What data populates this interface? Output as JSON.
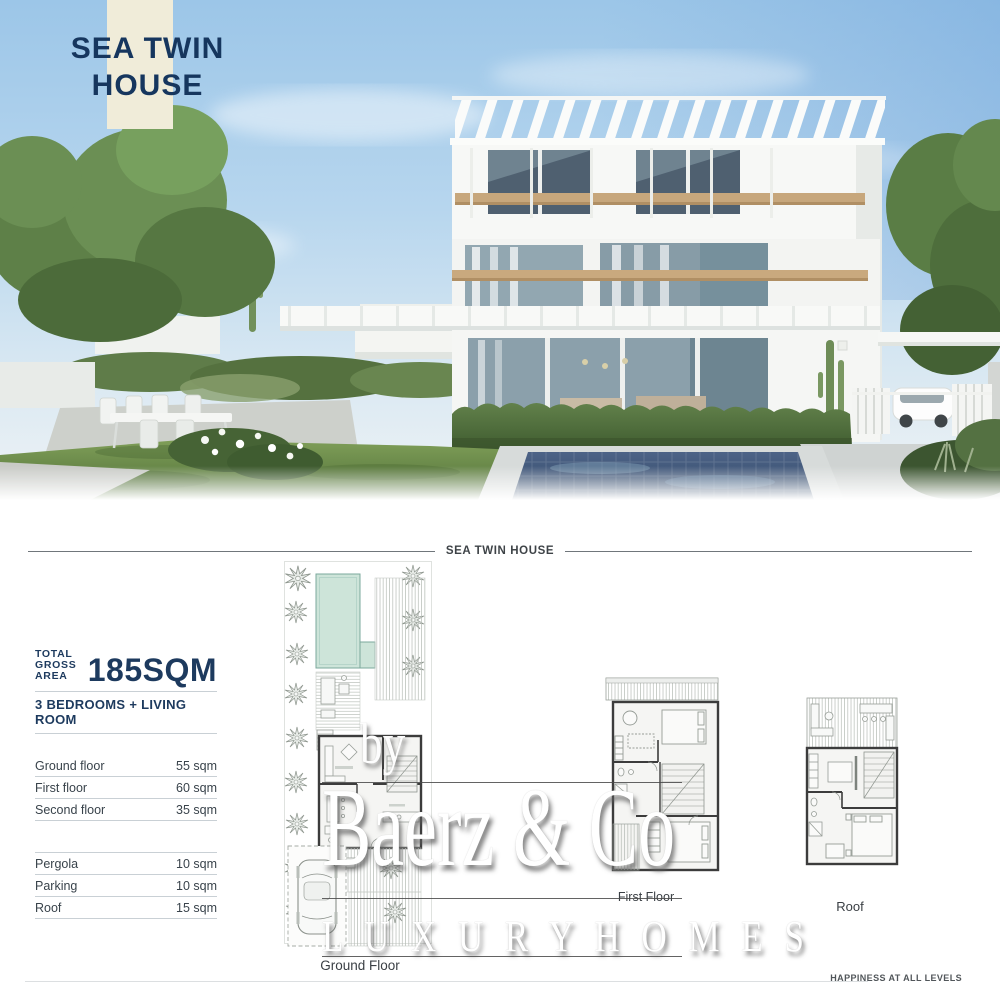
{
  "hero": {
    "title_line1": "SEA TWIN",
    "title_line2": "HOUSE",
    "scene": "villa-exterior-rendering-with-pool-and-garden"
  },
  "section_header": {
    "label": "SEA TWIN HOUSE"
  },
  "summary": {
    "total_label_line1": "TOTAL",
    "total_label_line2": "GROSS AREA",
    "total_value": "185SQM",
    "configuration": "3 BEDROOMS + LIVING ROOM",
    "areas_main": [
      {
        "label": "Ground floor",
        "value": "55 sqm"
      },
      {
        "label": "First floor",
        "value": "60 sqm"
      },
      {
        "label": "Second floor",
        "value": "35 sqm"
      }
    ],
    "areas_extra": [
      {
        "label": "Pergola",
        "value": "10 sqm"
      },
      {
        "label": "Parking",
        "value": "10 sqm"
      },
      {
        "label": "Roof",
        "value": "15 sqm"
      }
    ]
  },
  "floorplans": {
    "ground": {
      "label": "Ground Floor"
    },
    "first": {
      "label": "First Floor"
    },
    "roof": {
      "label": "Roof"
    }
  },
  "watermark": {
    "prefix": "by",
    "name": "Baerz & Co",
    "tagline": "L U X U R Y   H O M E S"
  },
  "footer": {
    "tagline": "HAPPINESS AT ALL LEVELS"
  },
  "colors": {
    "navy": "#1d3a5e",
    "cream": "#f0ecd9",
    "pool_plan_teal": "#cde4d9",
    "divider_gray": "#c9d0d5",
    "sky_blue": "#9cc6e8"
  }
}
